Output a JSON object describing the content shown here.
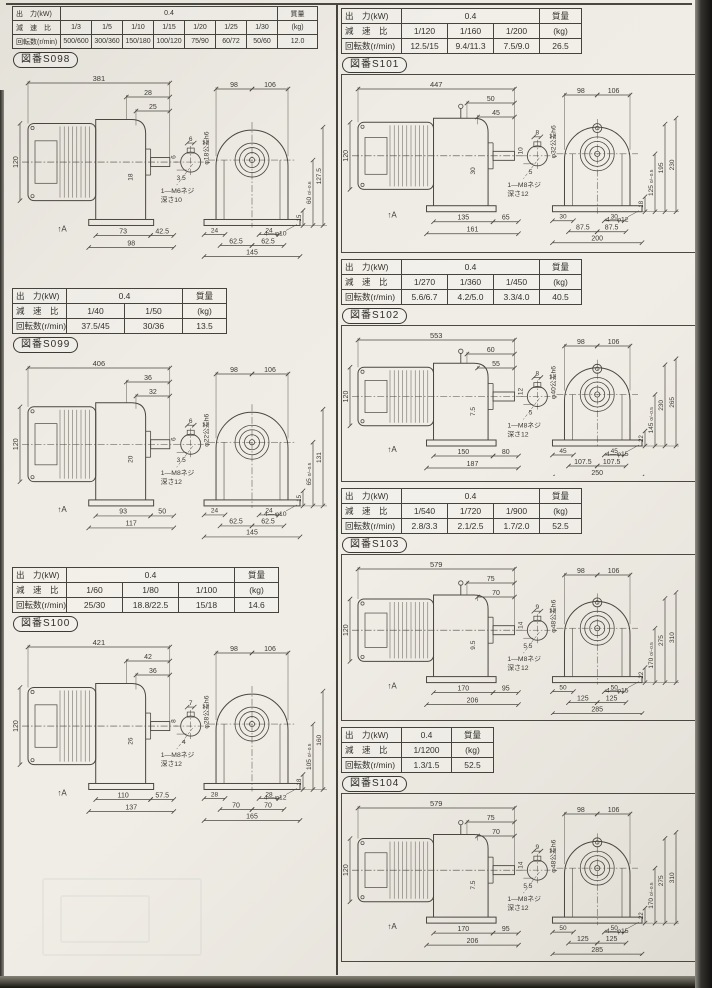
{
  "page": {
    "description": "Scanned gear-motor catalog page with specification tables and dimension drawings",
    "accent_line_color": "#45433c",
    "paper_color": "#edeae3"
  },
  "sections": [
    {
      "id": "S098",
      "figure_label": "図番S098",
      "table": {
        "output_label": "出　力(kW)",
        "output_value": "0.4",
        "ratio_label": "減　速　比",
        "speed_label": "回転数(r/min)",
        "mass_label": "質量",
        "mass_unit": "(kg)",
        "mass_value": "12.0",
        "ratios": [
          "1/3",
          "1/5",
          "1/10",
          "1/15",
          "1/20",
          "1/25",
          "1/30"
        ],
        "speeds": [
          "500/600",
          "300/360",
          "150/180",
          "100/120",
          "75/90",
          "60/72",
          "50/60"
        ]
      },
      "drawing": {
        "overall_length": "381",
        "case_dims": [
          "28",
          "25"
        ],
        "motor_height": "120",
        "shaft_side_dim": "18",
        "side_bottom": [
          "73",
          "42.5",
          "98"
        ],
        "key_width": "6",
        "key_side": "6",
        "key_depth": "3.5",
        "shaft_diameter_note": "φ18公差h6",
        "tap_note_line1": "1—M6ネジ",
        "tap_note_line2": "深さ10",
        "front_top": [
          "98",
          "106"
        ],
        "front_bolt_offsets": [
          "24",
          "24"
        ],
        "front_bolt_span": [
          "62.5",
          "62.5"
        ],
        "front_width_total": "145",
        "mounting_holes": "4—φ10",
        "foot_height": "15",
        "center_height": "60",
        "center_tolerance": "0/−0.6",
        "overall_heights": [
          "127.5"
        ],
        "view_arrow": "↑A"
      }
    },
    {
      "id": "S099",
      "figure_label": "図番S099",
      "table": {
        "output_label": "出　力(kW)",
        "output_value": "0.4",
        "ratio_label": "減　速　比",
        "speed_label": "回転数(r/min)",
        "mass_label": "質量",
        "mass_unit": "(kg)",
        "mass_value": "13.5",
        "ratios": [
          "1/40",
          "1/50"
        ],
        "speeds": [
          "37.5/45",
          "30/36"
        ]
      },
      "drawing": {
        "overall_length": "406",
        "case_dims": [
          "36",
          "32"
        ],
        "motor_height": "120",
        "shaft_side_dim": "20",
        "side_bottom": [
          "93",
          "50",
          "117"
        ],
        "key_width": "6",
        "key_side": "6",
        "key_depth": "3.5",
        "shaft_diameter_note": "φ22公差h6",
        "tap_note_line1": "1—M8ネジ",
        "tap_note_line2": "深さ12",
        "front_top": [
          "98",
          "106"
        ],
        "front_bolt_offsets": [
          "24",
          "24"
        ],
        "front_bolt_span": [
          "62.5",
          "62.5"
        ],
        "front_width_total": "145",
        "mounting_holes": "4—φ10",
        "foot_height": "15",
        "center_height": "65",
        "center_tolerance": "0/−0.5",
        "overall_heights": [
          "131"
        ],
        "view_arrow": "↑A"
      }
    },
    {
      "id": "S100",
      "figure_label": "図番S100",
      "table": {
        "output_label": "出　力(kW)",
        "output_value": "0.4",
        "ratio_label": "減　速　比",
        "speed_label": "回転数(r/min)",
        "mass_label": "質量",
        "mass_unit": "(kg)",
        "mass_value": "14.6",
        "ratios": [
          "1/60",
          "1/80",
          "1/100"
        ],
        "speeds": [
          "25/30",
          "18.8/22.5",
          "15/18"
        ]
      },
      "drawing": {
        "overall_length": "421",
        "case_dims": [
          "42",
          "36"
        ],
        "motor_height": "120",
        "shaft_side_dim": "26",
        "side_bottom": [
          "110",
          "57.5",
          "137"
        ],
        "key_width": "7",
        "key_side": "8",
        "key_depth": "4",
        "shaft_diameter_note": "φ28公差h6",
        "tap_note_line1": "1—M8ネジ",
        "tap_note_line2": "深さ12",
        "front_top": [
          "98",
          "106"
        ],
        "front_bolt_offsets": [
          "28",
          "28"
        ],
        "front_bolt_span": [
          "70",
          "70"
        ],
        "front_width_total": "165",
        "mounting_holes": "4—φ12",
        "foot_height": "18",
        "center_height": "105",
        "center_tolerance": "0/−0.5",
        "overall_heights": [
          "160"
        ],
        "view_arrow": "↑A"
      }
    },
    {
      "id": "S101",
      "figure_label": "図番S101",
      "table": {
        "output_label": "出　力(kW)",
        "output_value": "0.4",
        "ratio_label": "減　速　比",
        "speed_label": "回転数(r/min)",
        "mass_label": "質量",
        "mass_unit": "(kg)",
        "mass_value": "26.5",
        "ratios": [
          "1/120",
          "1/160",
          "1/200"
        ],
        "speeds": [
          "12.5/15",
          "9.4/11.3",
          "7.5/9.0"
        ]
      },
      "drawing": {
        "overall_length": "447",
        "case_dims": [
          "50",
          "45"
        ],
        "motor_height": "120",
        "shaft_side_dim": "30",
        "side_bottom": [
          "135",
          "65",
          "161"
        ],
        "key_width": "8",
        "key_side": "10",
        "key_depth": "5",
        "shaft_diameter_note": "φ32公差h6",
        "tap_note_line1": "1—M8ネジ",
        "tap_note_line2": "深さ12",
        "front_top": [
          "98",
          "106"
        ],
        "front_bolt_offsets": [
          "30",
          "30"
        ],
        "front_bolt_span": [
          "87.5",
          "87.5"
        ],
        "front_width_total": "200",
        "mounting_holes": "4—φ12",
        "foot_height": "18",
        "center_height": "125",
        "center_tolerance": "0/−0.5",
        "overall_heights": [
          "195",
          "230"
        ],
        "view_arrow": "↑A"
      }
    },
    {
      "id": "S102",
      "figure_label": "図番S102",
      "table": {
        "output_label": "出　力(kW)",
        "output_value": "0.4",
        "ratio_label": "減　速　比",
        "speed_label": "回転数(r/min)",
        "mass_label": "質量",
        "mass_unit": "(kg)",
        "mass_value": "40.5",
        "ratios": [
          "1/270",
          "1/360",
          "1/450"
        ],
        "speeds": [
          "5.6/6.7",
          "4.2/5.0",
          "3.3/4.0"
        ]
      },
      "drawing": {
        "overall_length": "553",
        "case_dims": [
          "60",
          "55"
        ],
        "motor_height": "120",
        "shaft_side_dim": "7.5",
        "side_bottom": [
          "150",
          "80",
          "187"
        ],
        "key_width": "8",
        "key_side": "12",
        "key_depth": "5",
        "shaft_diameter_note": "φ40公差h6",
        "tap_note_line1": "1—M8ネジ",
        "tap_note_line2": "深さ12",
        "front_top": [
          "98",
          "106"
        ],
        "front_bolt_offsets": [
          "45",
          "45"
        ],
        "front_bolt_span": [
          "107.5",
          "107.5"
        ],
        "front_width_total": "250",
        "mounting_holes": "4—φ15",
        "foot_height": "22",
        "center_height": "145",
        "center_tolerance": "0/−0.5",
        "overall_heights": [
          "230",
          "265"
        ],
        "view_arrow": "↑A"
      }
    },
    {
      "id": "S103",
      "figure_label": "図番S103",
      "table": {
        "output_label": "出　力(kW)",
        "output_value": "0.4",
        "ratio_label": "減　速　比",
        "speed_label": "回転数(r/min)",
        "mass_label": "質量",
        "mass_unit": "(kg)",
        "mass_value": "52.5",
        "ratios": [
          "1/540",
          "1/720",
          "1/900"
        ],
        "speeds": [
          "2.8/3.3",
          "2.1/2.5",
          "1.7/2.0"
        ]
      },
      "drawing": {
        "overall_length": "579",
        "case_dims": [
          "75",
          "70"
        ],
        "motor_height": "120",
        "shaft_side_dim": "9.5",
        "side_bottom": [
          "170",
          "95",
          "206"
        ],
        "key_width": "9",
        "key_side": "14",
        "key_depth": "5.5",
        "shaft_diameter_note": "φ48公差h6",
        "tap_note_line1": "1—M8ネジ",
        "tap_note_line2": "深さ12",
        "front_top": [
          "98",
          "106"
        ],
        "front_bolt_offsets": [
          "50",
          "50"
        ],
        "front_bolt_span": [
          "125",
          "125"
        ],
        "front_width_total": "285",
        "mounting_holes": "4—φ15",
        "foot_height": "22",
        "center_height": "170",
        "center_tolerance": "0/−0.5",
        "overall_heights": [
          "275",
          "310"
        ],
        "view_arrow": "↑A"
      }
    },
    {
      "id": "S104",
      "figure_label": "図番S104",
      "table": {
        "output_label": "出　力(kW)",
        "output_value": "0.4",
        "ratio_label": "減　速　比",
        "speed_label": "回転数(r/min)",
        "mass_label": "質量",
        "mass_unit": "(kg)",
        "mass_value": "52.5",
        "ratios": [
          "1/1200"
        ],
        "speeds": [
          "1.3/1.5"
        ]
      },
      "drawing": {
        "overall_length": "579",
        "case_dims": [
          "75",
          "70"
        ],
        "motor_height": "120",
        "shaft_side_dim": "7.5",
        "side_bottom": [
          "170",
          "95",
          "206"
        ],
        "key_width": "9",
        "key_side": "14",
        "key_depth": "5.5",
        "shaft_diameter_note": "φ48公差h6",
        "tap_note_line1": "1—M8ネジ",
        "tap_note_line2": "深さ12",
        "front_top": [
          "98",
          "106"
        ],
        "front_bolt_offsets": [
          "50",
          "50"
        ],
        "front_bolt_span": [
          "125",
          "125"
        ],
        "front_width_total": "285",
        "mounting_holes": "4—φ15",
        "foot_height": "22",
        "center_height": "170",
        "center_tolerance": "0/−0.5",
        "overall_heights": [
          "275",
          "310"
        ],
        "view_arrow": "↑A"
      }
    }
  ]
}
